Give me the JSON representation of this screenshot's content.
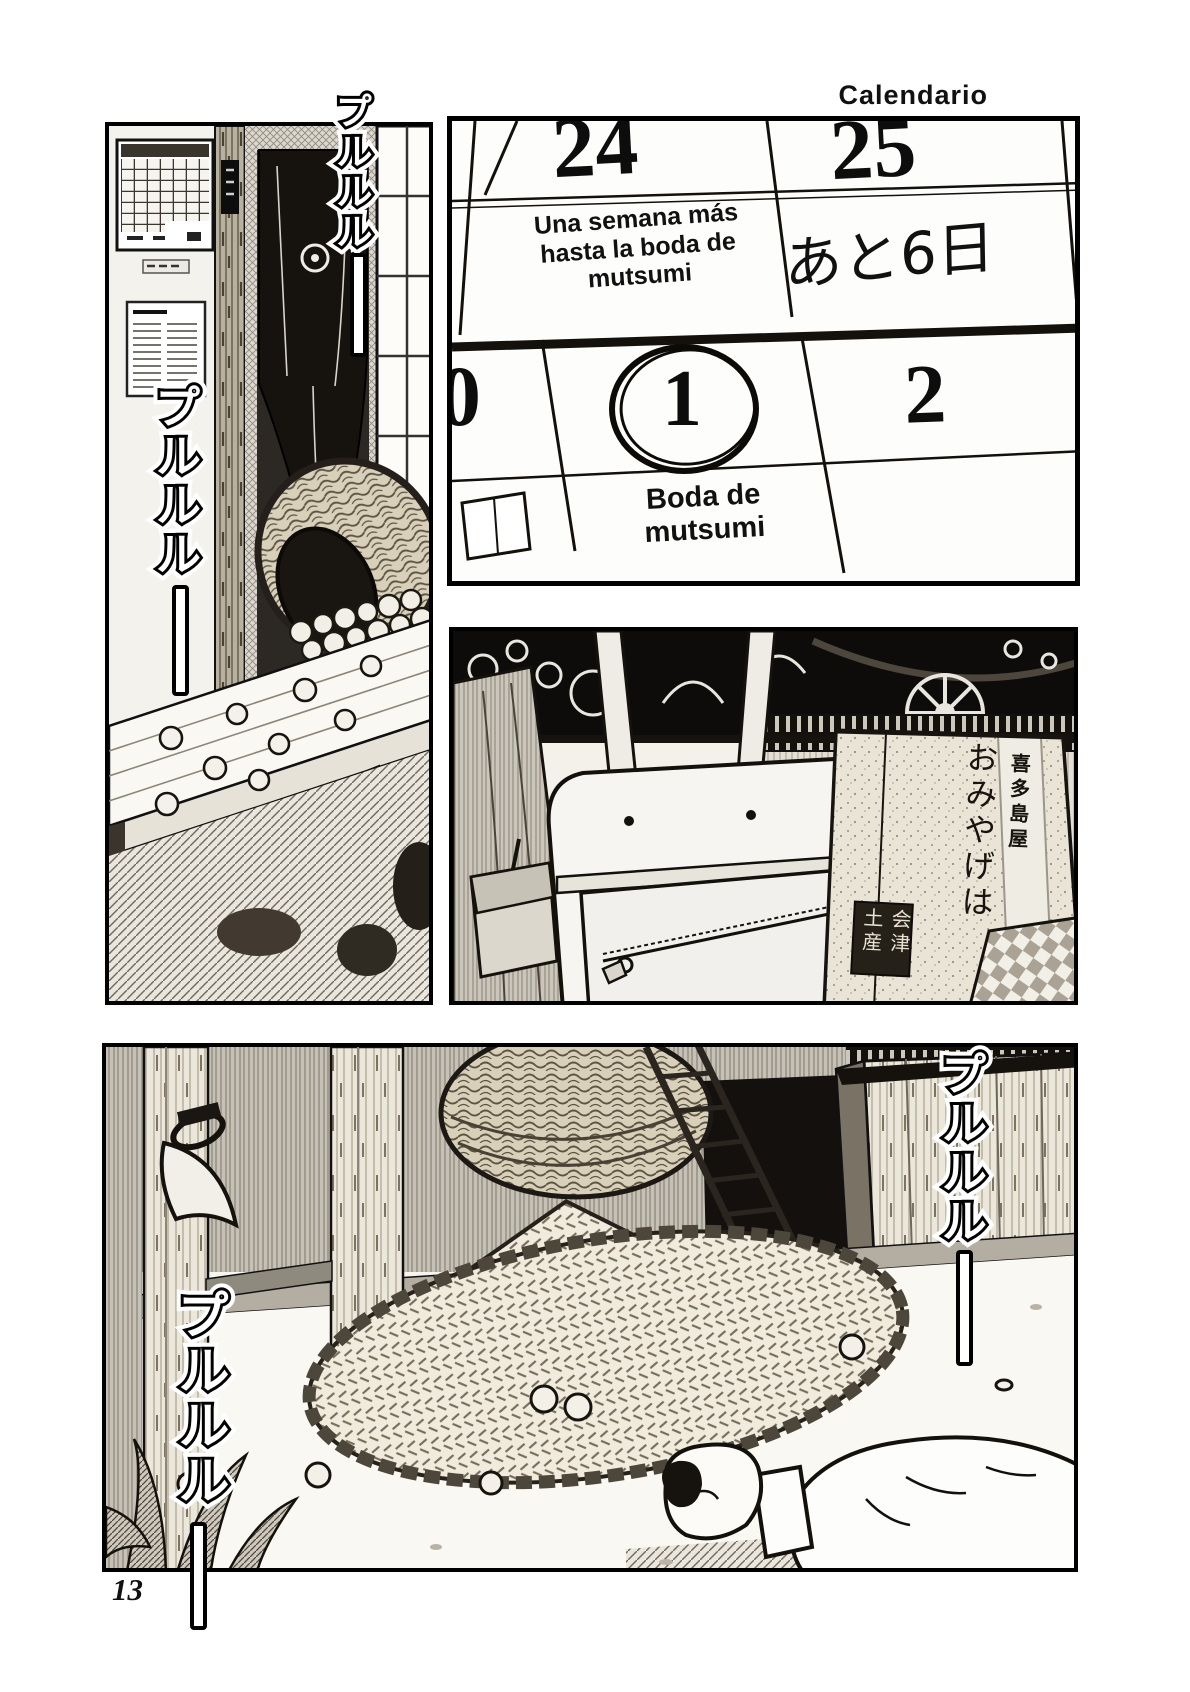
{
  "page": {
    "header_label": "Calendario",
    "page_number": "13"
  },
  "calendar_panel": {
    "day_top_left": "24",
    "day_top_right": "25",
    "note": {
      "line1": "Una semana más",
      "line2": "hasta la boda de",
      "line3": "mutsumi"
    },
    "handwritten_countdown": "あと6日",
    "day_bottom_left": "0",
    "day_bottom_center": "1",
    "day_bottom_right": "2",
    "event": {
      "line1": "Boda de",
      "line2": "mutsumi"
    }
  },
  "luggage_panel": {
    "shopping_bag_text": "おみやげは",
    "shopping_bag_shop_name": "喜多島屋",
    "shopping_bag_stamp": "会津土産"
  },
  "sfx": {
    "phone_ring_1": "プルルル",
    "phone_ring_2": "プルルル",
    "phone_ring_3": "プルルル",
    "phone_ring_4": "プルルル"
  }
}
